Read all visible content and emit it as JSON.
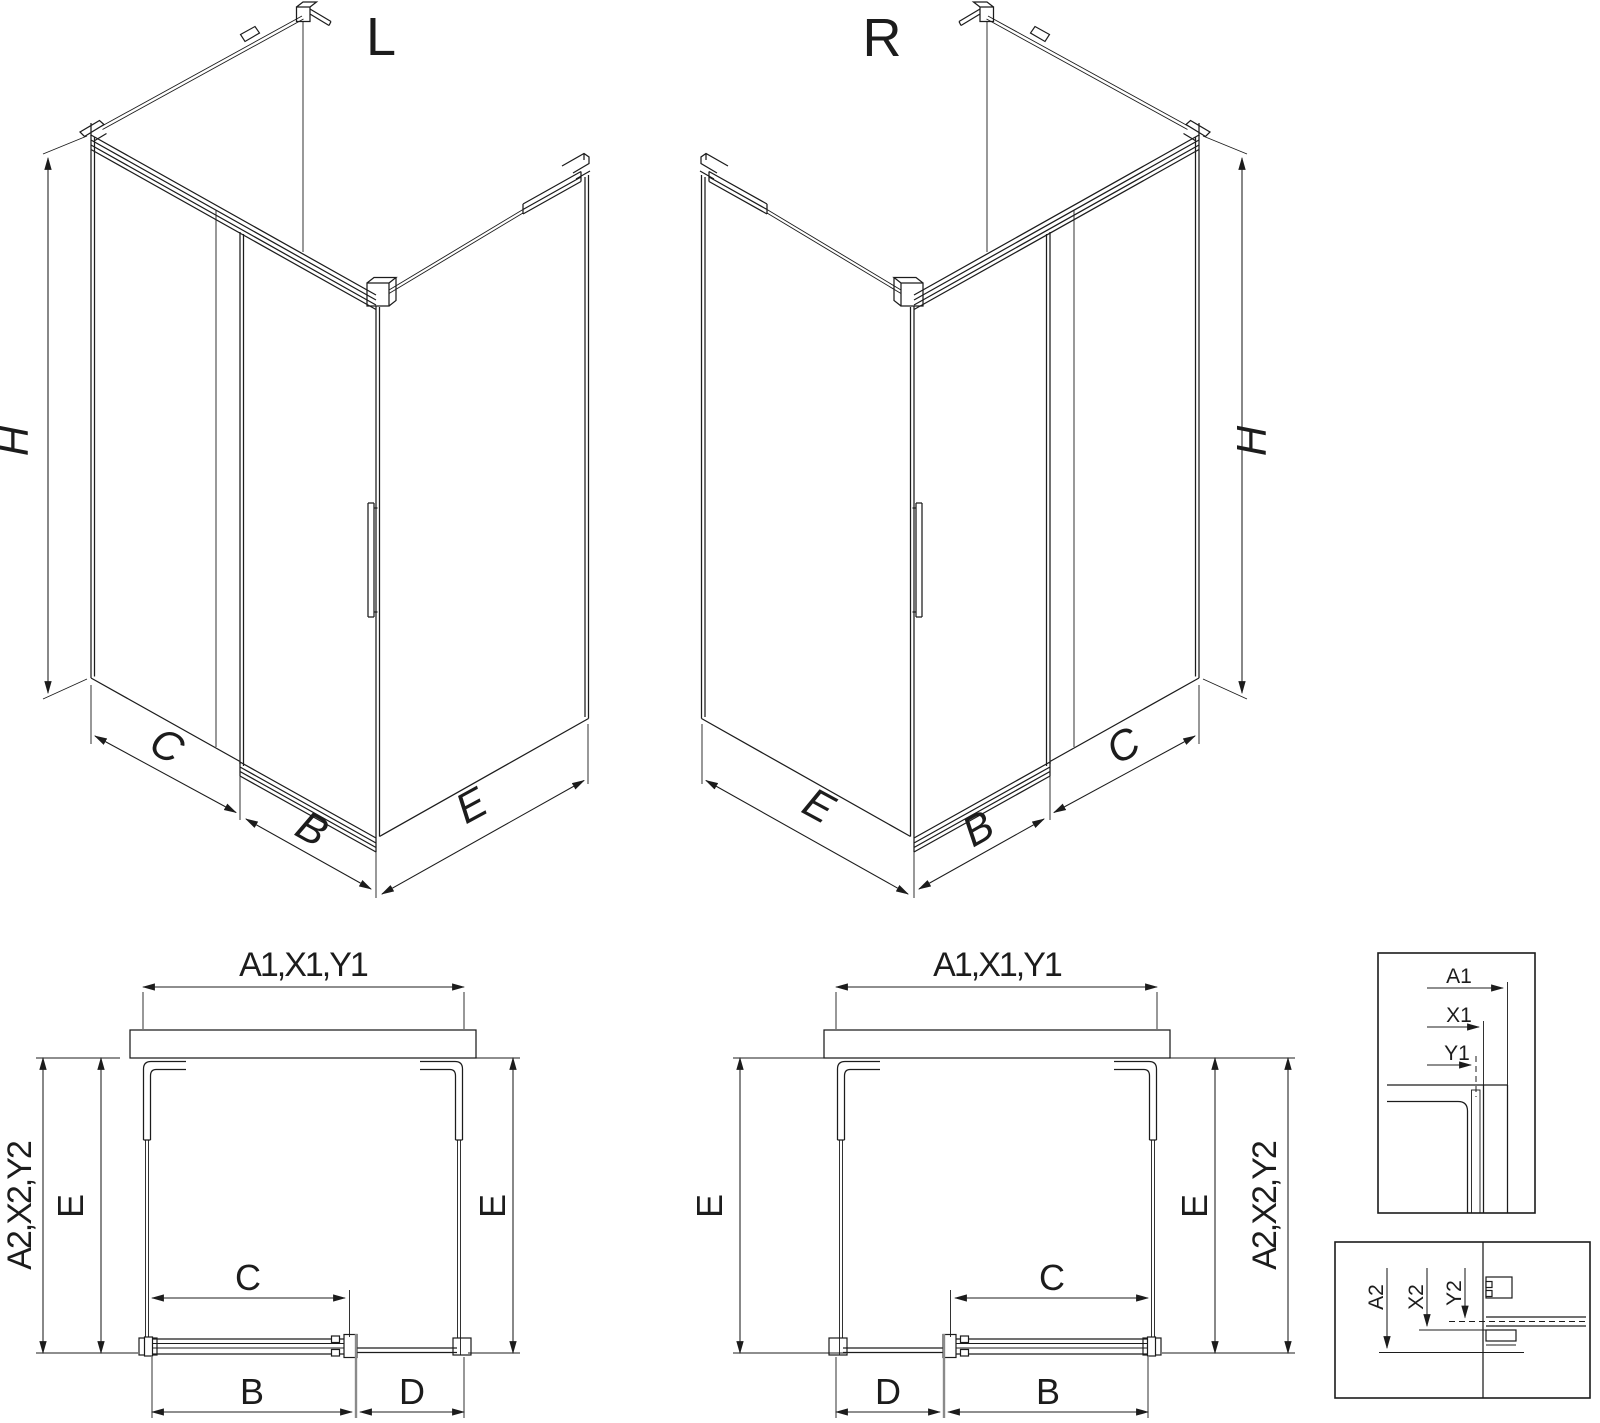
{
  "drawing": {
    "background": "#ffffff",
    "line_color": "#1c1c1c",
    "views": {
      "iso_left": {
        "title": "L",
        "dim_height": "H",
        "dim_front_fixed": "C",
        "dim_door": "B",
        "dim_side": "E"
      },
      "iso_right": {
        "title": "R",
        "dim_height": "H",
        "dim_front_fixed": "C",
        "dim_door": "B",
        "dim_side": "E"
      },
      "plan_left": {
        "dim_width": "A1,X1,Y1",
        "dim_depth": "A2,X2,Y2",
        "dim_side_left": "E",
        "dim_side_right": "E",
        "dim_opening": "C",
        "dim_door": "B",
        "dim_fixed": "D"
      },
      "plan_right": {
        "dim_width": "A1,X1,Y1",
        "dim_depth": "A2,X2,Y2",
        "dim_side_left": "E",
        "dim_side_right": "E",
        "dim_opening": "C",
        "dim_door": "B",
        "dim_fixed": "D"
      },
      "detail_width": {
        "dim_a": "A1",
        "dim_x": "X1",
        "dim_y": "Y1"
      },
      "detail_depth": {
        "dim_a": "A2",
        "dim_x": "X2",
        "dim_y": "Y2"
      }
    }
  }
}
